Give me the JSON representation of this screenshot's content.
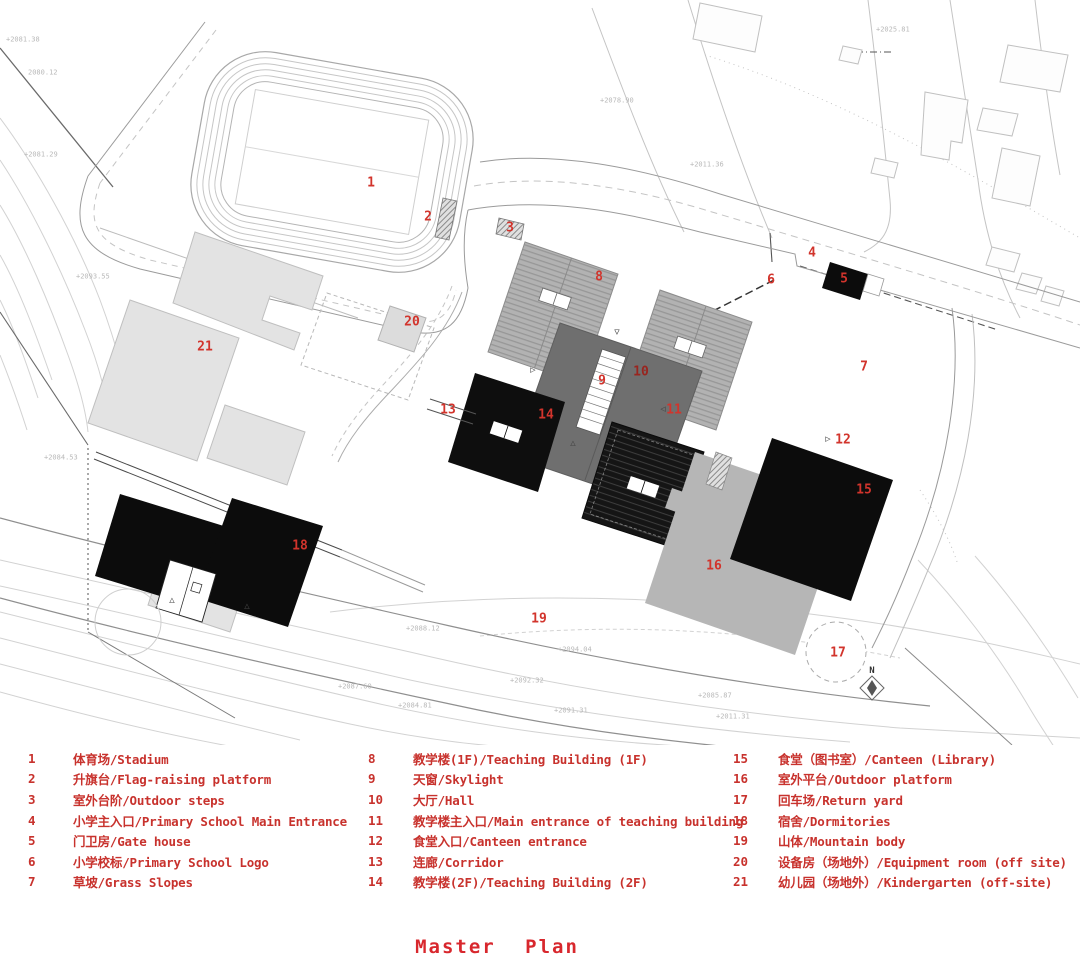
{
  "title": "Master Plan",
  "colors": {
    "label_red": "#d2342c",
    "legend_red": "#c8322d",
    "title_red": "#d8272d",
    "building_black": "#0d0d0d",
    "hall_gray": "#6f6f6f",
    "hatch_gray": "#b2b2b2",
    "platform_gray": "#b6b6b6",
    "context_gray": "#e3e3e3"
  },
  "legend": {
    "columns": [
      {
        "items": [
          {
            "no": "1",
            "label": "体育场/Stadium"
          },
          {
            "no": "2",
            "label": "升旗台/Flag-raising platform"
          },
          {
            "no": "3",
            "label": "室外台阶/Outdoor steps"
          },
          {
            "no": "4",
            "label": "小学主入口/Primary School Main Entrance"
          },
          {
            "no": "5",
            "label": "门卫房/Gate house"
          },
          {
            "no": "6",
            "label": "小学校标/Primary School Logo"
          },
          {
            "no": "7",
            "label": "草坡/Grass Slopes"
          }
        ]
      },
      {
        "items": [
          {
            "no": "8",
            "label": "教学楼(1F)/Teaching Building (1F)"
          },
          {
            "no": "9",
            "label": "天窗/Skylight"
          },
          {
            "no": "10",
            "label": "大厅/Hall"
          },
          {
            "no": "11",
            "label": "教学楼主入口/Main entrance of teaching building"
          },
          {
            "no": "12",
            "label": "食堂入口/Canteen entrance"
          },
          {
            "no": "13",
            "label": "连廊/Corridor"
          },
          {
            "no": "14",
            "label": "教学楼(2F)/Teaching Building (2F)"
          }
        ]
      },
      {
        "items": [
          {
            "no": "15",
            "label": "食堂（图书室）/Canteen (Library)"
          },
          {
            "no": "16",
            "label": "室外平台/Outdoor platform"
          },
          {
            "no": "17",
            "label": "回车场/Return yard"
          },
          {
            "no": "18",
            "label": "宿舍/Dormitories"
          },
          {
            "no": "19",
            "label": "山体/Mountain body"
          },
          {
            "no": "20",
            "label": "设备房（场地外）/Equipment room (off site)"
          },
          {
            "no": "21",
            "label": "幼儿园（场地外）/Kindergarten (off-site)"
          }
        ]
      }
    ]
  },
  "plan": {
    "north_label": "N",
    "labels": [
      {
        "no": "1",
        "x": 371,
        "y": 183
      },
      {
        "no": "2",
        "x": 428,
        "y": 217
      },
      {
        "no": "3",
        "x": 510,
        "y": 228
      },
      {
        "no": "4",
        "x": 812,
        "y": 253
      },
      {
        "no": "5",
        "x": 844,
        "y": 279
      },
      {
        "no": "6",
        "x": 771,
        "y": 280
      },
      {
        "no": "7",
        "x": 864,
        "y": 367
      },
      {
        "no": "8",
        "x": 599,
        "y": 277
      },
      {
        "no": "9",
        "x": 602,
        "y": 381
      },
      {
        "no": "10",
        "x": 641,
        "y": 372,
        "dark": true
      },
      {
        "no": "11",
        "x": 674,
        "y": 410
      },
      {
        "no": "12",
        "x": 843,
        "y": 440
      },
      {
        "no": "13",
        "x": 448,
        "y": 410
      },
      {
        "no": "14",
        "x": 546,
        "y": 415
      },
      {
        "no": "15",
        "x": 864,
        "y": 490
      },
      {
        "no": "16",
        "x": 714,
        "y": 566
      },
      {
        "no": "17",
        "x": 838,
        "y": 653
      },
      {
        "no": "18",
        "x": 300,
        "y": 546
      },
      {
        "no": "19",
        "x": 539,
        "y": 619
      },
      {
        "no": "20",
        "x": 412,
        "y": 322
      },
      {
        "no": "21",
        "x": 205,
        "y": 347
      }
    ],
    "markers": [
      {
        "glyph": "▽",
        "x": 617,
        "y": 333
      },
      {
        "glyph": "▷",
        "x": 533,
        "y": 371
      },
      {
        "glyph": "△",
        "x": 573,
        "y": 444
      },
      {
        "glyph": "◁",
        "x": 663,
        "y": 410
      },
      {
        "glyph": "▷",
        "x": 828,
        "y": 440
      },
      {
        "glyph": "△",
        "x": 172,
        "y": 601
      },
      {
        "glyph": "△",
        "x": 247,
        "y": 607
      }
    ],
    "elevations": [
      {
        "text": "+2081.38",
        "x": 6,
        "y": 40
      },
      {
        "text": "2080.12",
        "x": 28,
        "y": 73
      },
      {
        "text": "+2081.29",
        "x": 24,
        "y": 155
      },
      {
        "text": "+2093.55",
        "x": 76,
        "y": 277
      },
      {
        "text": "+2084.53",
        "x": 44,
        "y": 458
      },
      {
        "text": "+2025.81",
        "x": 876,
        "y": 30
      },
      {
        "text": "+2078.90",
        "x": 600,
        "y": 101
      },
      {
        "text": "+2011.36",
        "x": 690,
        "y": 165
      },
      {
        "text": "+2088.12",
        "x": 406,
        "y": 629
      },
      {
        "text": "+2094.04",
        "x": 558,
        "y": 650
      },
      {
        "text": "+2092.32",
        "x": 510,
        "y": 681
      },
      {
        "text": "+2087.60",
        "x": 338,
        "y": 687
      },
      {
        "text": "+2084.81",
        "x": 398,
        "y": 706
      },
      {
        "text": "+2091.31",
        "x": 554,
        "y": 711
      },
      {
        "text": "+2085.87",
        "x": 698,
        "y": 696
      },
      {
        "text": "+2011.31",
        "x": 716,
        "y": 717
      }
    ]
  }
}
